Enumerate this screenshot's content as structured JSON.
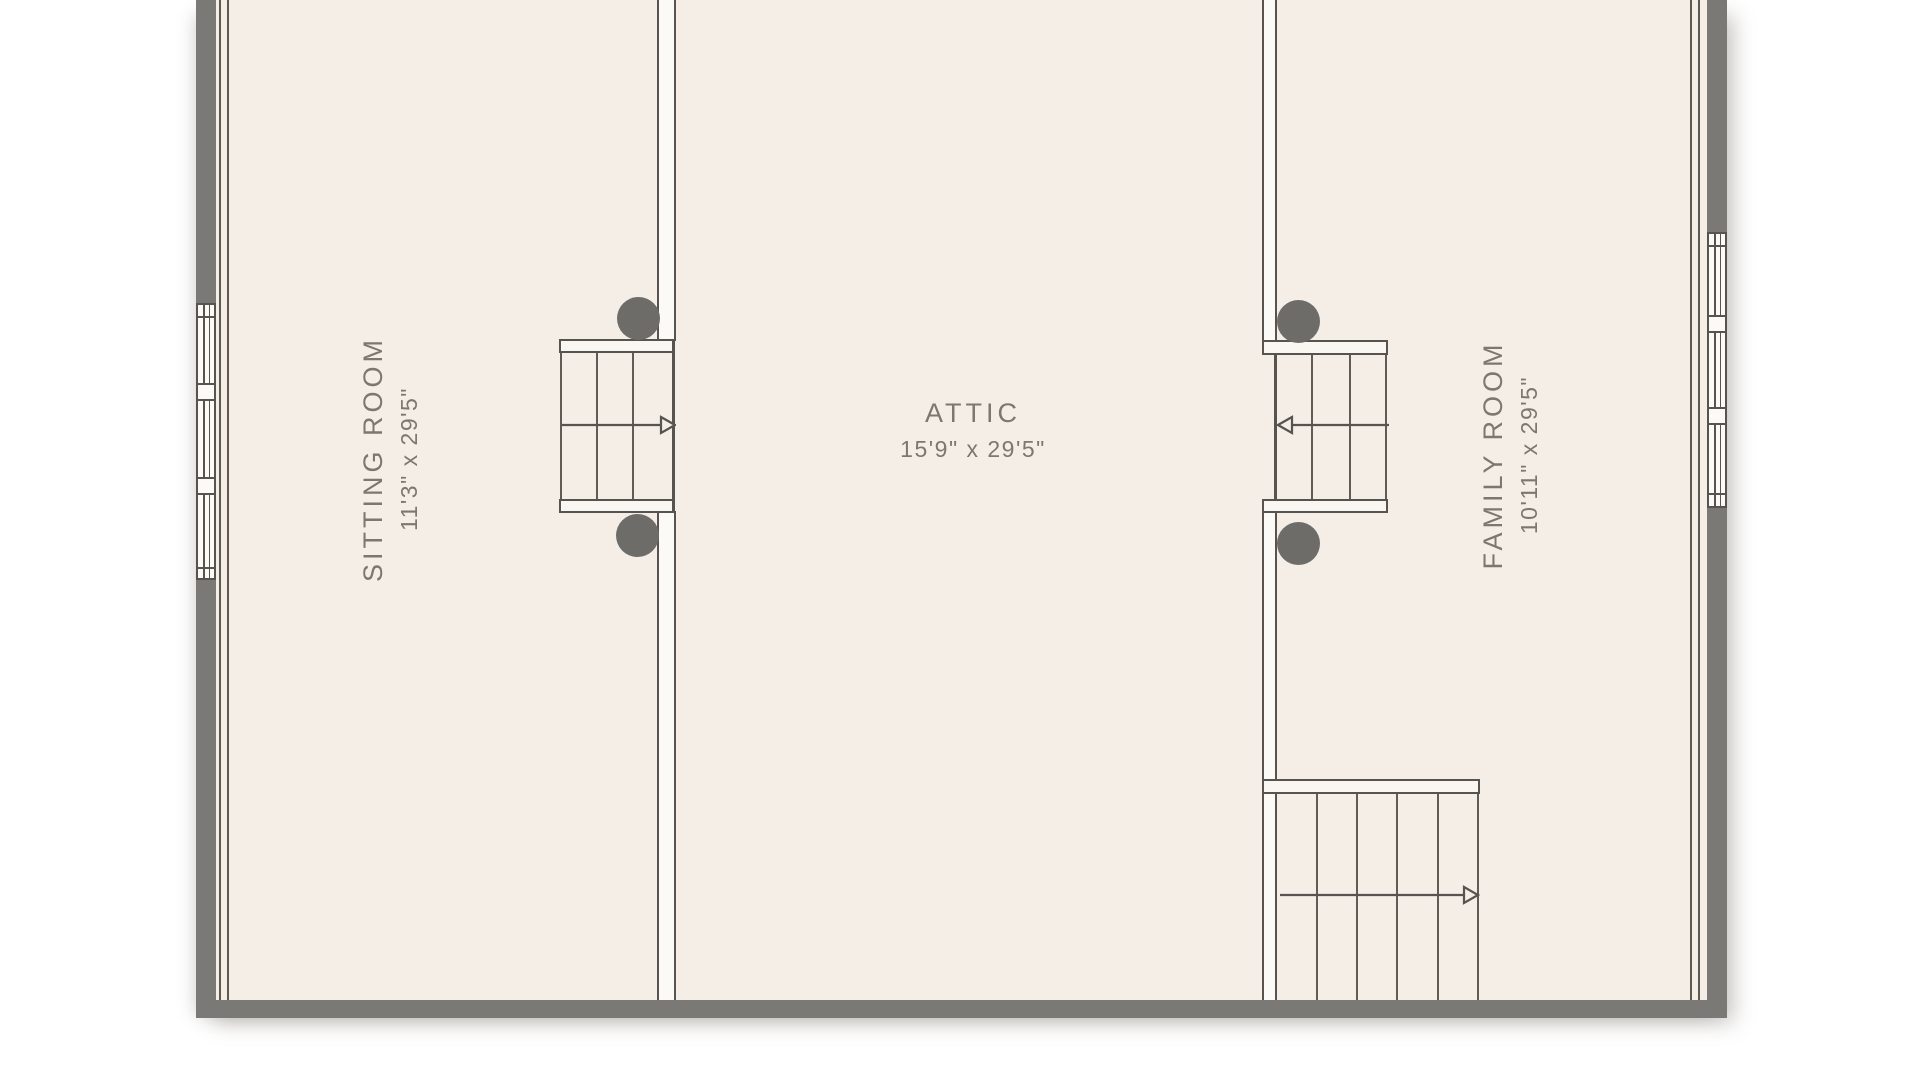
{
  "plan": {
    "rooms": [
      {
        "name": "SITTING ROOM",
        "dimensions": "11'3\" x 29'5\""
      },
      {
        "name": "ATTIC",
        "dimensions": "15'9\" x 29'5\""
      },
      {
        "name": "FAMILY ROOM",
        "dimensions": "10'11\" x 29'5\""
      }
    ],
    "features": {
      "staircase_count": 3,
      "stair_arrow_directions": [
        "right",
        "left",
        "right"
      ],
      "window_count": 2,
      "post_count": 4
    }
  },
  "palette": {
    "page_background": "#ffffff",
    "floor_fill": "#f5eee7",
    "exterior_wall_gray": "#7b7975",
    "plan_line": "#57534e",
    "label_text": "#7d776f",
    "fixture_fill": "#fcfaf7",
    "post_gray": "#6e6c69"
  }
}
